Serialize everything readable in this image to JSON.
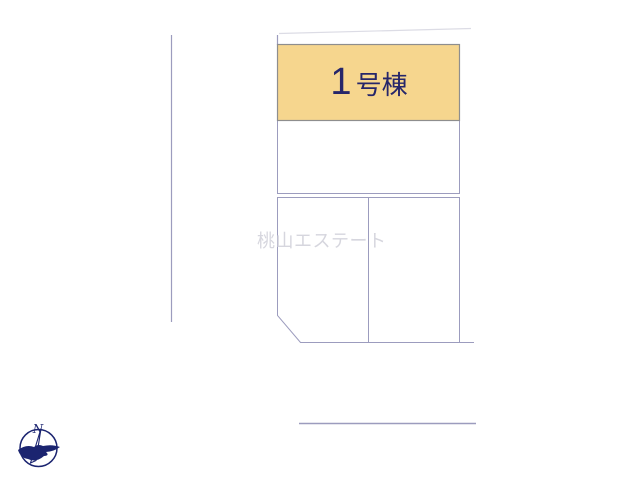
{
  "site_plan": {
    "highlighted_plot": {
      "full_label": "1号棟",
      "number": "1",
      "suffix": "号棟"
    },
    "unlabeled_plot_count": 3,
    "watermark": {
      "text": "桃山エステート"
    },
    "compass": {
      "north_label": "N"
    },
    "colors": {
      "background": "#FFFFFF",
      "boundary_line": "#9C9CBE",
      "faint_boundary_line": "#DCDCE5",
      "highlight_fill": "#F6D68E",
      "highlight_border": "#8E8E8E",
      "plot_fill": "#FFFFFF",
      "label_text": "#26266A",
      "watermark_text": "#D6D6DE",
      "compass_color": "#1B2470"
    }
  }
}
